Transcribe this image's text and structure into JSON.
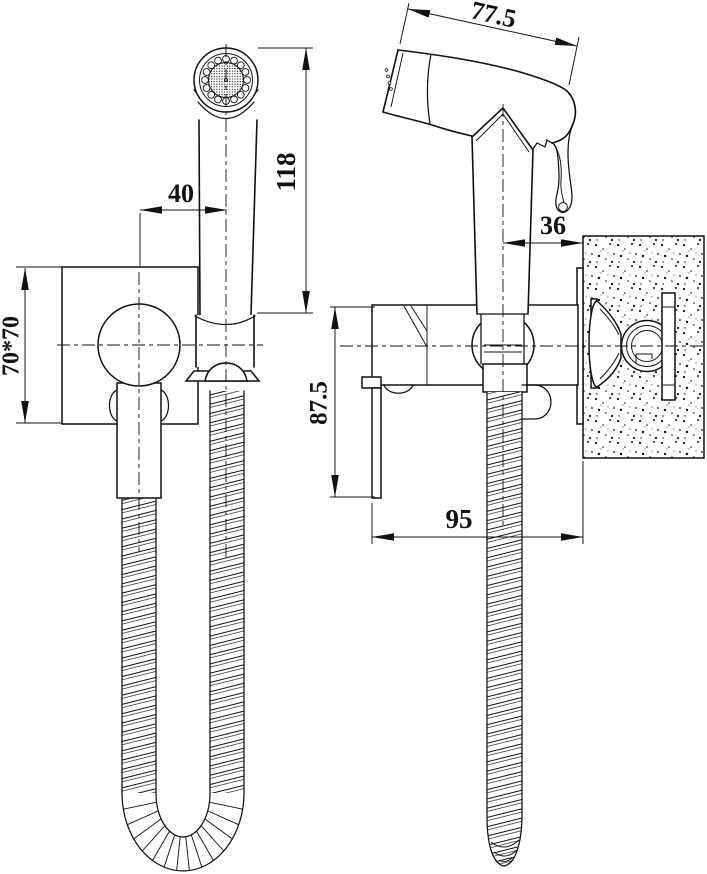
{
  "drawing": {
    "dimensions": {
      "head_length": "77.5",
      "handle_offset": "40",
      "sprayer_height": "118",
      "nozzle_to_wall": "36",
      "plate_size": "70*70",
      "body_drop": "87.5",
      "wall_depth": "95"
    }
  }
}
